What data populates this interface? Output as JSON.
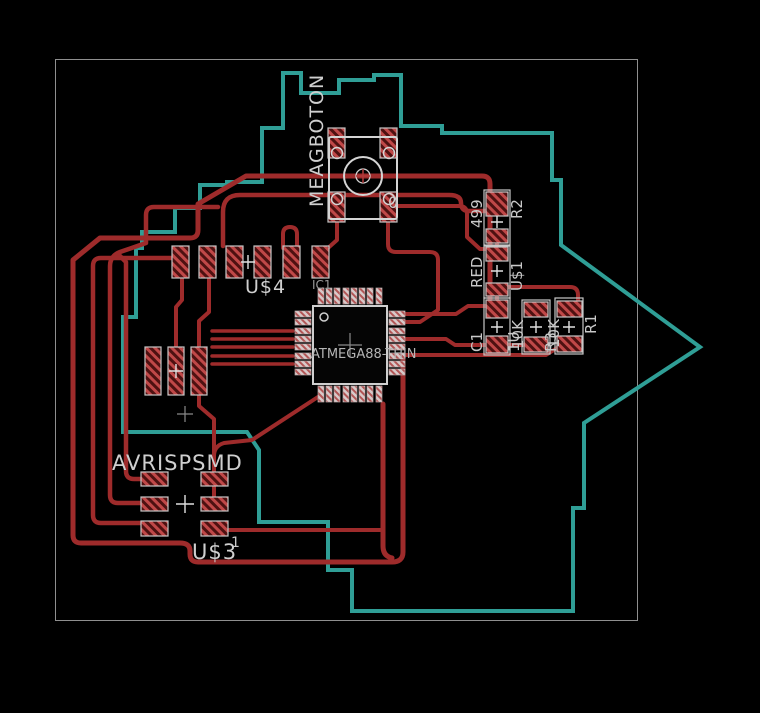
{
  "app": {
    "view": "pcb-board-layout",
    "background": "#000000",
    "board_outline_color": "#8f8f8f"
  },
  "layers": {
    "top_copper_color": "#9e2b2b",
    "bottom_copper_color": "#2f9e96",
    "silkscreen_color": "#d4d4d4",
    "pad_hatch_color": "#c04848"
  },
  "labels": {
    "button_name": "MEAGBOTON",
    "button_value": "0",
    "r2_value": "499",
    "r2_name": "R2",
    "led_value": "RED",
    "led_name": "U$1",
    "c1_name": "C1",
    "c1_value": "1U",
    "r3_value": "10K",
    "r3_name": "R3",
    "r1_value": "10K",
    "r1_name": "R1",
    "u4_name": "U$4",
    "ic_name": "IC1",
    "ic_value": "ATMEGA88-THIN",
    "isp_name": "AVRISPSMD",
    "u3_name": "U$3",
    "u3_pin1": "1"
  }
}
